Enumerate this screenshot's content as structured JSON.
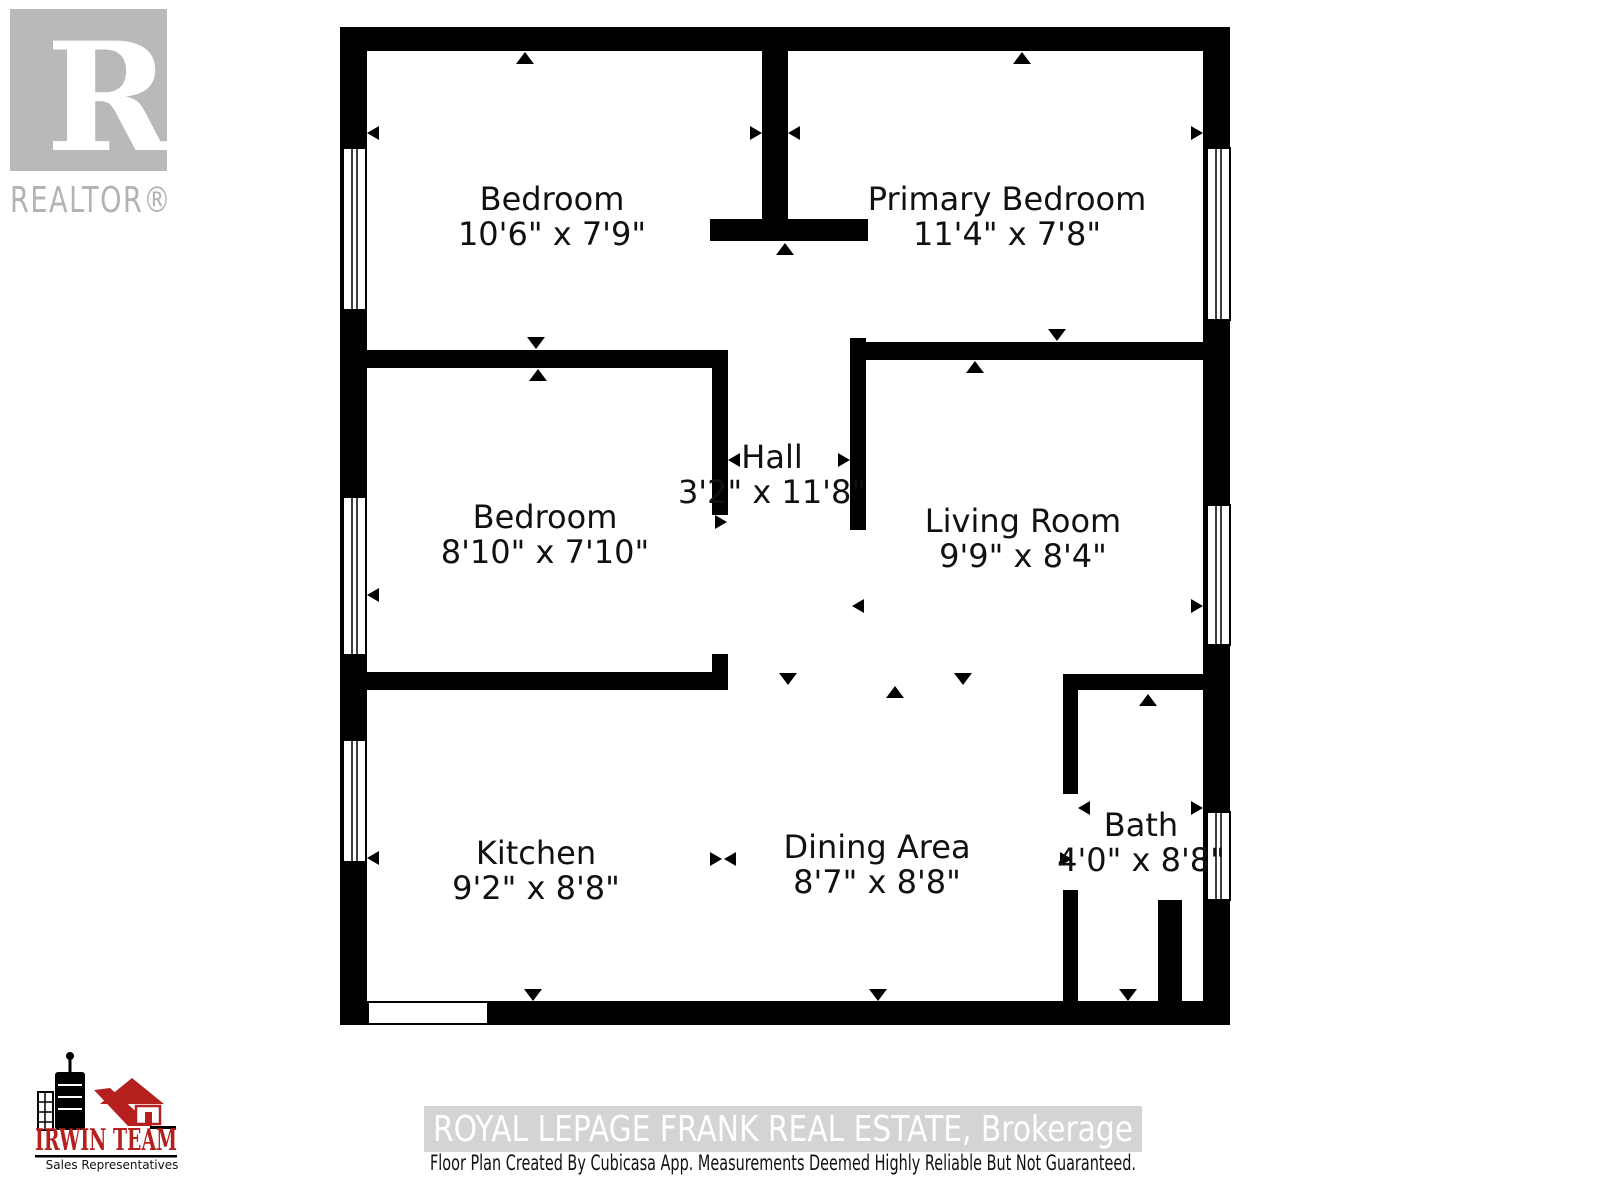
{
  "branding": {
    "realtor_r": "R",
    "realtor_logo_text": "REALTOR®",
    "irwin_team": "IRWIN TEAM",
    "irwin_subtitle": "Sales Representatives"
  },
  "rooms": [
    {
      "name": "Bedroom",
      "dims": "10'6\" x 7'9\""
    },
    {
      "name": "Primary Bedroom",
      "dims": "11'4\" x 7'8\""
    },
    {
      "name": "Hall",
      "dims": "3'2\" x 11'8\""
    },
    {
      "name": "Bedroom",
      "dims": "8'10\" x 7'10\""
    },
    {
      "name": "Living Room",
      "dims": "9'9\" x 8'4\""
    },
    {
      "name": "Kitchen",
      "dims": "9'2\" x 8'8\""
    },
    {
      "name": "Dining Area",
      "dims": "8'7\" x 8'8\""
    },
    {
      "name": "Bath",
      "dims": "4'0\" x 8'8\""
    }
  ],
  "footer": {
    "watermark": "ROYAL LEPAGE FRANK REAL ESTATE, Brokerage",
    "disclaimer": "Floor Plan Created By Cubicasa App. Measurements Deemed Highly Reliable But Not Guaranteed."
  },
  "colors": {
    "wall": "#000000",
    "logo_gray": "#b9b9b9",
    "watermark_band": "#d4d4d4",
    "watermark_text": "#ffffff",
    "irwin_red": "#b5201f"
  }
}
